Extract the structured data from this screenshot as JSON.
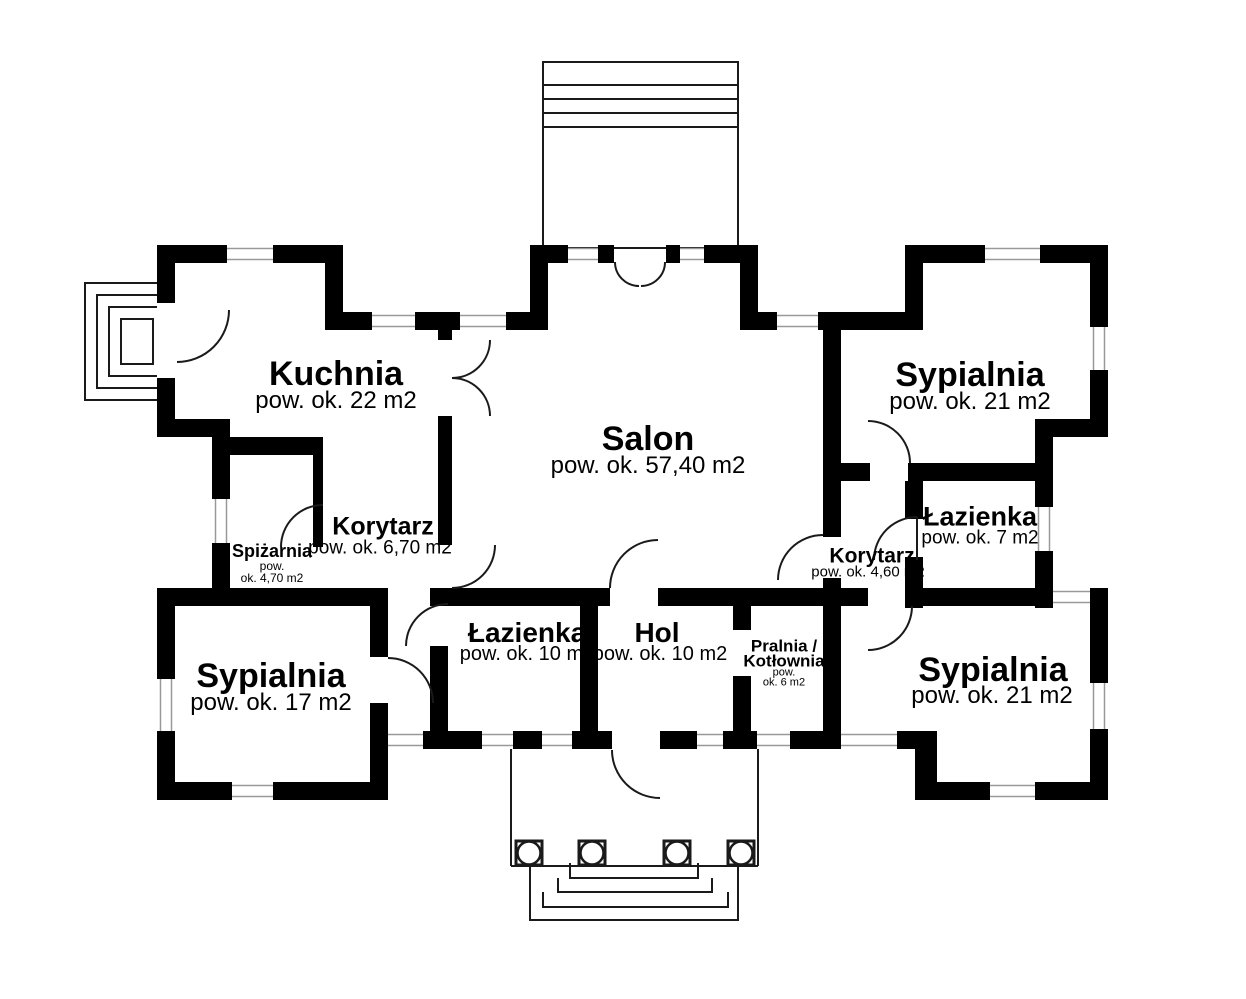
{
  "plan": {
    "type": "floor-plan",
    "language": "pl",
    "colors": {
      "wall": "#000000",
      "background": "#ffffff",
      "thin_line": "#1a1a1a",
      "window_line": "#999999",
      "text": "#000000"
    },
    "rooms": {
      "kuchnia": {
        "name": "Kuchnia",
        "area": "pow. ok. 22 m2"
      },
      "salon": {
        "name": "Salon",
        "area": "pow. ok. 57,40 m2"
      },
      "sypialnia_top_right": {
        "name": "Sypialnia",
        "area": "pow. ok. 21 m2"
      },
      "lazienka_right": {
        "name": "Łazienka",
        "area": "pow. ok. 7 m2"
      },
      "korytarz_right": {
        "name": "Korytarz",
        "area": "pow. ok. 4,60 m2"
      },
      "korytarz_left": {
        "name": "Korytarz",
        "area": "pow. ok. 6,70 m2"
      },
      "spizarnia": {
        "name": "Spiżarnia",
        "area_line1": "pow.",
        "area_line2": "ok. 4,70 m2"
      },
      "sypialnia_left": {
        "name": "Sypialnia",
        "area": "pow. ok. 17 m2"
      },
      "lazienka_bottom": {
        "name": "Łazienka",
        "area": "pow. ok. 10 m2"
      },
      "hol": {
        "name": "Hol",
        "area": "pow. ok. 10 m2"
      },
      "pralnia_kotlownia": {
        "name_line1": "Pralnia /",
        "name_line2": "Kotłownia",
        "area_line1": "pow.",
        "area_line2": "ok. 6 m2"
      },
      "sypialnia_bottom_right": {
        "name": "Sypialnia",
        "area": "pow. ok. 21 m2"
      }
    }
  }
}
